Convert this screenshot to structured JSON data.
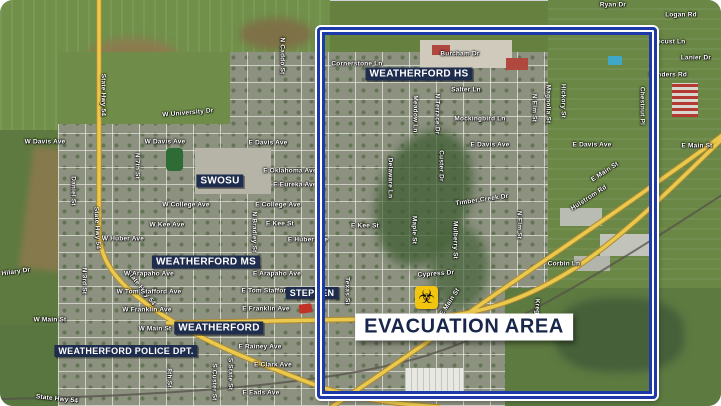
{
  "map": {
    "description": "Satellite evacuation map of Weatherford",
    "colors": {
      "boundary_blue": "#1e3aa8",
      "poi_navy": "#1e2c4e",
      "road_yellow": "#eac94f",
      "hazard_yellow": "#f2c50f",
      "evac_text": "#17264a"
    },
    "icons": {
      "biohazard": "☣"
    }
  },
  "evacuation": {
    "label": "EVACUATION AREA",
    "x": 464,
    "y": 327
  },
  "poi_labels": [
    {
      "id": "weatherford-hs",
      "t": "WEATHERFORD HS",
      "x": 419,
      "y": 74,
      "fs": 10,
      "under": false
    },
    {
      "id": "swosu",
      "t": "SWOSU",
      "x": 220,
      "y": 181,
      "fs": 10,
      "under": false
    },
    {
      "id": "weatherford-ms",
      "t": "WEATHERFORD MS",
      "x": 206,
      "y": 262,
      "fs": 10,
      "under": false
    },
    {
      "id": "weatherford",
      "t": "WEATHERFORD",
      "x": 219,
      "y": 328,
      "fs": 10,
      "under": false
    },
    {
      "id": "weatherford-police-dpt",
      "t": "WEATHERFORD POLICE DPT.",
      "x": 126,
      "y": 351,
      "fs": 9,
      "under": false
    },
    {
      "id": "stephen",
      "t": "STEPHEN",
      "x": 312,
      "y": 293,
      "fs": 9,
      "under": true
    }
  ],
  "street_labels": [
    {
      "t": "State Hwy 54",
      "x": 103,
      "y": 95,
      "r": 90
    },
    {
      "t": "State Hwy 54",
      "x": 97,
      "y": 228,
      "r": 87
    },
    {
      "t": "State Hwy 54",
      "x": 141,
      "y": 288,
      "r": 52
    },
    {
      "t": "State Hwy 54",
      "x": 57,
      "y": 399,
      "r": 6
    },
    {
      "t": "W Davis Ave",
      "x": 45,
      "y": 142,
      "r": 0
    },
    {
      "t": "W Davis Ave",
      "x": 165,
      "y": 142,
      "r": 0
    },
    {
      "t": "E Davis Ave",
      "x": 268,
      "y": 143,
      "r": 0
    },
    {
      "t": "E Davis Ave",
      "x": 490,
      "y": 145,
      "r": 0
    },
    {
      "t": "E Davis Ave",
      "x": 592,
      "y": 145,
      "r": 0
    },
    {
      "t": "W University Dr",
      "x": 188,
      "y": 113,
      "r": -5
    },
    {
      "t": "N 7th St",
      "x": 137,
      "y": 166,
      "r": 90
    },
    {
      "t": "Daniel St",
      "x": 73,
      "y": 191,
      "r": 90
    },
    {
      "t": "N Caddo St",
      "x": 282,
      "y": 56,
      "r": 90
    },
    {
      "t": "W College Ave",
      "x": 186,
      "y": 205,
      "r": 0
    },
    {
      "t": "E College Ave",
      "x": 278,
      "y": 205,
      "r": 0
    },
    {
      "t": "W Kee Ave",
      "x": 167,
      "y": 225,
      "r": 0
    },
    {
      "t": "E Kee St",
      "x": 280,
      "y": 224,
      "r": 0
    },
    {
      "t": "E Kee St",
      "x": 365,
      "y": 226,
      "r": 0
    },
    {
      "t": "W Huber Ave",
      "x": 123,
      "y": 239,
      "r": 0
    },
    {
      "t": "E Huber Ave",
      "x": 308,
      "y": 240,
      "r": 0
    },
    {
      "t": "W Arapaho Ave",
      "x": 149,
      "y": 274,
      "r": 0
    },
    {
      "t": "E Arapaho Ave",
      "x": 277,
      "y": 274,
      "r": 0
    },
    {
      "t": "W Tom Stafford Ave",
      "x": 149,
      "y": 292,
      "r": 0
    },
    {
      "t": "E Tom Stafford Ave",
      "x": 273,
      "y": 291,
      "r": 0
    },
    {
      "t": "W Franklin Ave",
      "x": 147,
      "y": 310,
      "r": 0
    },
    {
      "t": "E Franklin Ave",
      "x": 266,
      "y": 309,
      "r": 0
    },
    {
      "t": "W Main St",
      "x": 50,
      "y": 320,
      "r": 0
    },
    {
      "t": "W Main St",
      "x": 155,
      "y": 329,
      "r": 0
    },
    {
      "t": "E Rainey Ave",
      "x": 260,
      "y": 347,
      "r": 0
    },
    {
      "t": "E Clark Ave",
      "x": 273,
      "y": 365,
      "r": 0
    },
    {
      "t": "E Eads Ave",
      "x": 261,
      "y": 393,
      "r": 0
    },
    {
      "t": "N 3rd St",
      "x": 84,
      "y": 281,
      "r": 90
    },
    {
      "t": "8th St",
      "x": 169,
      "y": 378,
      "r": 90
    },
    {
      "t": "S Custer St",
      "x": 214,
      "y": 382,
      "r": 90
    },
    {
      "t": "S State St",
      "x": 230,
      "y": 374,
      "r": 90
    },
    {
      "t": "N Bradley St",
      "x": 254,
      "y": 232,
      "r": 90
    },
    {
      "t": "Texas St",
      "x": 347,
      "y": 291,
      "r": 90
    },
    {
      "t": "Hilary Dr",
      "x": 16,
      "y": 272,
      "r": -8
    },
    {
      "t": "Cornerstone Ln",
      "x": 357,
      "y": 64,
      "r": 0
    },
    {
      "t": "Burcham Dr",
      "x": 460,
      "y": 54,
      "r": 0
    },
    {
      "t": "Salter Ln",
      "x": 466,
      "y": 90,
      "r": 0
    },
    {
      "t": "Mockingbird Ln",
      "x": 480,
      "y": 119,
      "r": 0
    },
    {
      "t": "Meadow Ln",
      "x": 415,
      "y": 114,
      "r": 90
    },
    {
      "t": "N Terrace Dr",
      "x": 437,
      "y": 114,
      "r": 90
    },
    {
      "t": "Custer Dr",
      "x": 441,
      "y": 166,
      "r": 90
    },
    {
      "t": "Delaware Ln",
      "x": 390,
      "y": 178,
      "r": 90
    },
    {
      "t": "Timber Creek Dr",
      "x": 482,
      "y": 200,
      "r": -8
    },
    {
      "t": "Maple St",
      "x": 414,
      "y": 230,
      "r": 90
    },
    {
      "t": "Mulberry St",
      "x": 455,
      "y": 240,
      "r": 90
    },
    {
      "t": "N Elm St",
      "x": 534,
      "y": 108,
      "r": 90
    },
    {
      "t": "N Elm St",
      "x": 519,
      "y": 225,
      "r": 90
    },
    {
      "t": "Magnolia St",
      "x": 548,
      "y": 104,
      "r": 90
    },
    {
      "t": "Hickory St",
      "x": 563,
      "y": 101,
      "r": 90
    },
    {
      "t": "Chestnut Pl",
      "x": 642,
      "y": 106,
      "r": 90
    },
    {
      "t": "E Oklahoma Ave",
      "x": 290,
      "y": 171,
      "r": 0
    },
    {
      "t": "E Eureka Ave",
      "x": 295,
      "y": 185,
      "r": 0
    },
    {
      "t": "Cypress Dr",
      "x": 436,
      "y": 274,
      "r": -4
    },
    {
      "t": "E Main St",
      "x": 450,
      "y": 302,
      "r": -57
    },
    {
      "t": "E Main St",
      "x": 605,
      "y": 172,
      "r": -33
    },
    {
      "t": "E Main St",
      "x": 697,
      "y": 146,
      "r": 0
    },
    {
      "t": "Hulstrom Rd",
      "x": 589,
      "y": 198,
      "r": -33
    },
    {
      "t": "Kreger Ln",
      "x": 537,
      "y": 315,
      "r": 90
    },
    {
      "t": "Corbin Ln",
      "x": 564,
      "y": 264,
      "r": 0
    },
    {
      "t": "Ryan Dr",
      "x": 613,
      "y": 5,
      "r": 0
    },
    {
      "t": "Logan Rd",
      "x": 681,
      "y": 15,
      "r": 0
    },
    {
      "t": "Locust Ln",
      "x": 669,
      "y": 42,
      "r": 0
    },
    {
      "t": "Lanier Dr",
      "x": 696,
      "y": 58,
      "r": 0
    },
    {
      "t": "Sanders Rd",
      "x": 668,
      "y": 75,
      "r": 0
    }
  ]
}
